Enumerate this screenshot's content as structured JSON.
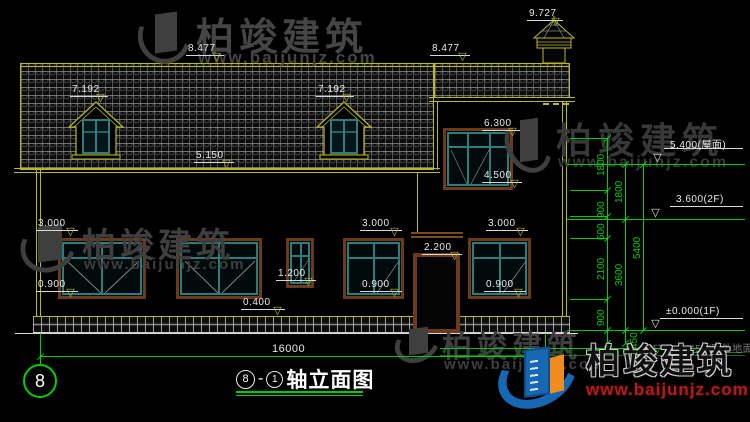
{
  "colors": {
    "background": "#000000",
    "cad_yellow": "#b9b923",
    "cad_green": "#00cc00",
    "cad_white": "#e8e8e8",
    "window_frame_brown": "#6b3b1c",
    "window_mullion_teal": "#2e7d7d",
    "watermark_gray": "#3f3f3f",
    "logo_blue": "#1668b4",
    "logo_orange": "#f08c1e",
    "logo_site_red": "#a82020"
  },
  "title": {
    "b1": "8",
    "dash": "-",
    "b2": "1",
    "text": "轴立面图"
  },
  "axis_bubbles": [
    {
      "label": "8",
      "cx": 40,
      "cy": 381,
      "r": 17,
      "font": 18
    },
    {
      "label": "1",
      "cx": 546,
      "cy": 379,
      "r": 14,
      "font": 13
    }
  ],
  "overall_dim": {
    "text": "16000",
    "x1": 40,
    "x2": 545,
    "y": 356,
    "text_x": 272,
    "text_y": 343
  },
  "elevation_markers": [
    {
      "text": "8.477",
      "x": 186,
      "y": 63,
      "w": 38
    },
    {
      "text": "8.477",
      "x": 430,
      "y": 63,
      "w": 40
    },
    {
      "text": "9.727",
      "x": 527,
      "y": 28,
      "w": 36
    },
    {
      "text": "7.192",
      "x": 70,
      "y": 104,
      "w": 38
    },
    {
      "text": "7.192",
      "x": 316,
      "y": 104,
      "w": 38
    },
    {
      "text": "5.150",
      "x": 194,
      "y": 170,
      "w": 40
    },
    {
      "text": "6.300",
      "x": 482,
      "y": 138,
      "w": 38
    },
    {
      "text": "4.500",
      "x": 482,
      "y": 190,
      "w": 40
    },
    {
      "text": "3.000",
      "x": 36,
      "y": 238,
      "w": 42
    },
    {
      "text": "3.000",
      "x": 360,
      "y": 238,
      "w": 42
    },
    {
      "text": "3.000",
      "x": 486,
      "y": 238,
      "w": 42
    },
    {
      "text": "2.200",
      "x": 422,
      "y": 262,
      "w": 40
    },
    {
      "text": "1.200",
      "x": 276,
      "y": 288,
      "w": 40
    },
    {
      "text": "0.900",
      "x": 36,
      "y": 299,
      "w": 42
    },
    {
      "text": "0.900",
      "x": 360,
      "y": 299,
      "w": 42
    },
    {
      "text": "0.900",
      "x": 484,
      "y": 299,
      "w": 42
    },
    {
      "text": "0.400",
      "x": 241,
      "y": 317,
      "w": 44
    }
  ],
  "right_level_markers": [
    {
      "text": "5.400(屋面)",
      "tx": 670,
      "ty": 136,
      "tri_x": 652,
      "y": 164,
      "ex1": 567,
      "ex2": 745,
      "faint": false
    },
    {
      "text": "3.600(2F)",
      "tx": 676,
      "ty": 194,
      "tri_x": 650,
      "y": 219,
      "ex1": 567,
      "ex2": 745,
      "faint": false
    },
    {
      "text": "±0.000(1F)",
      "tx": 666,
      "ty": 306,
      "tri_x": 650,
      "y": 330,
      "ex1": 567,
      "ex2": 745,
      "faint": false
    },
    {
      "text": "-0.450(室外地面)",
      "tx": 676,
      "ty": 340,
      "tri_x": 652,
      "y": 355,
      "ex1": 440,
      "ex2": 745,
      "faint": true
    }
  ],
  "vertical_dim_columns": [
    {
      "x": 607,
      "y1": 138,
      "y2": 343,
      "ticks": [
        138,
        190,
        216,
        238,
        299,
        330,
        343
      ],
      "labels": [
        {
          "text": "1800",
          "cy": 164
        },
        {
          "text": "900",
          "cy": 206
        },
        {
          "text": "600",
          "cy": 228
        },
        {
          "text": "2100",
          "cy": 268
        },
        {
          "text": "900",
          "cy": 314
        }
      ]
    },
    {
      "x": 625,
      "y1": 164,
      "y2": 343,
      "ticks": [
        164,
        219,
        330,
        343
      ],
      "labels": [
        {
          "text": "1800",
          "cy": 191
        },
        {
          "text": "3600",
          "cy": 274
        },
        {
          "text": "450",
          "cy": 337,
          "lx": 629
        }
      ]
    },
    {
      "x": 643,
      "y1": 164,
      "y2": 330,
      "ticks": [
        164,
        330
      ],
      "labels": [
        {
          "text": "5400",
          "cy": 247
        }
      ]
    }
  ],
  "connectors": [
    {
      "x1": 570,
      "x2": 607,
      "y": 138
    },
    {
      "x1": 570,
      "x2": 643,
      "y": 164
    },
    {
      "x1": 570,
      "x2": 607,
      "y": 190
    },
    {
      "x1": 570,
      "x2": 607,
      "y": 216
    },
    {
      "x1": 570,
      "x2": 607,
      "y": 238
    },
    {
      "x1": 570,
      "x2": 607,
      "y": 299
    },
    {
      "x1": 570,
      "x2": 643,
      "y": 330
    },
    {
      "x1": 440,
      "x2": 700,
      "y": 348
    }
  ],
  "bubble_stems": [
    {
      "x": 40,
      "y1": 333,
      "y2": 364
    },
    {
      "x": 545,
      "y1": 333,
      "y2": 365
    }
  ],
  "watermarks": {
    "brand": "柏竣建筑",
    "site": "www.baijunjz.com"
  }
}
